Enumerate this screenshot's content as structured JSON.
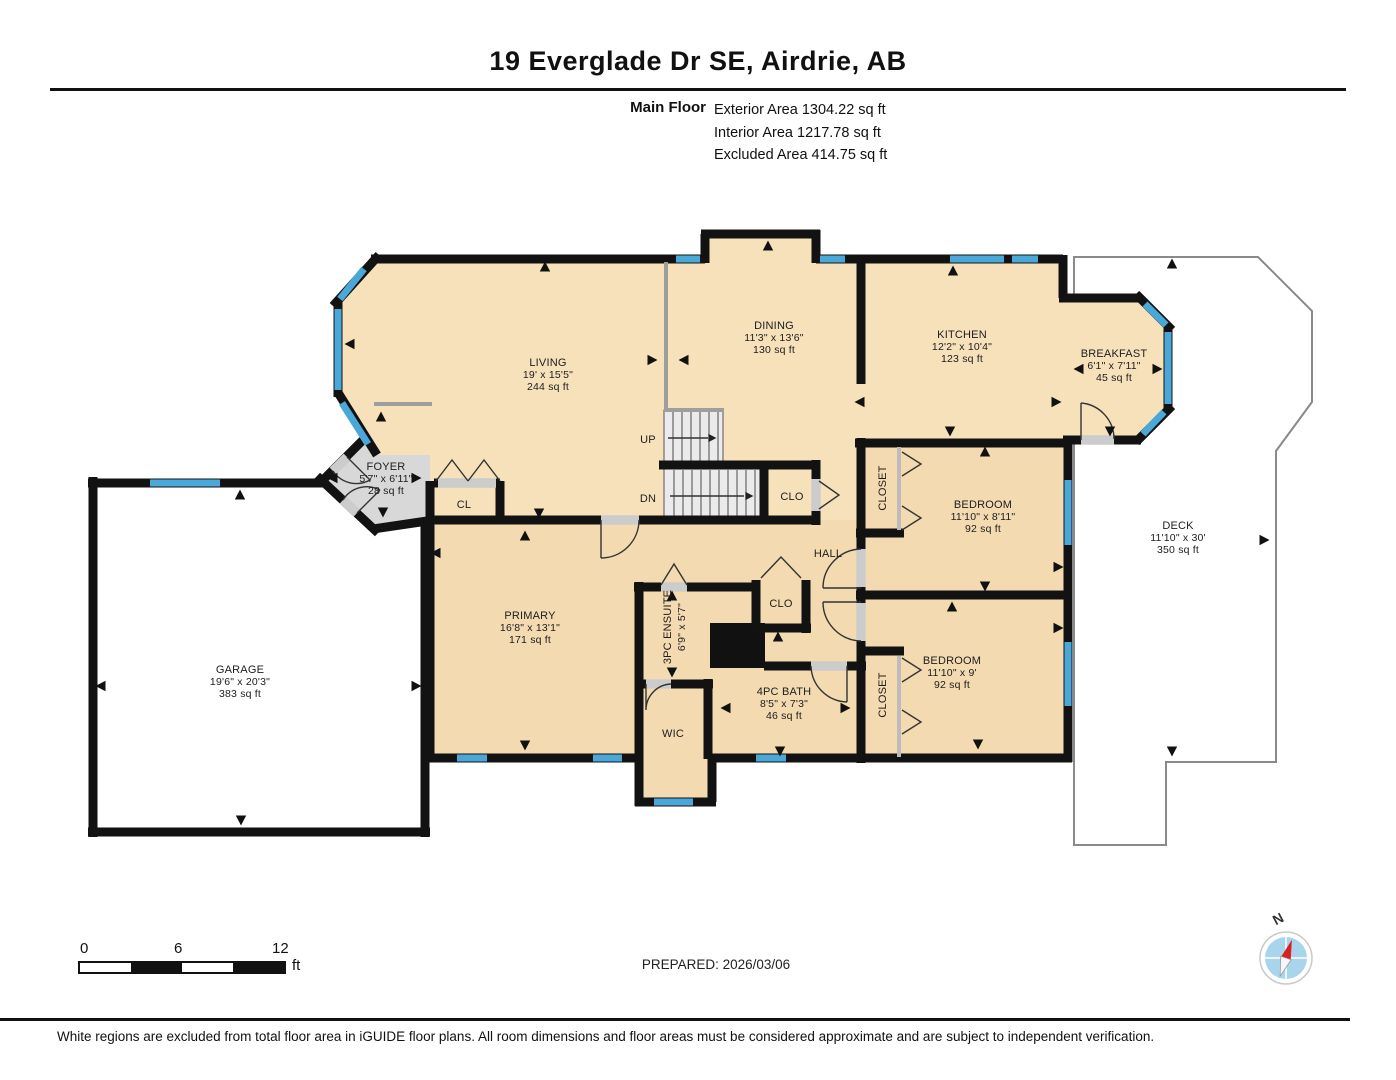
{
  "header": {
    "title": "19 Everglade Dr SE, Airdrie, AB",
    "floor_label": "Main Floor",
    "areas": [
      "Exterior Area 1304.22 sq ft",
      "Interior Area 1217.78 sq ft",
      "Excluded Area 414.75 sq ft"
    ]
  },
  "rooms": {
    "living": {
      "name": "LIVING",
      "dims": "19' x 15'5\"",
      "area": "244 sq ft"
    },
    "dining": {
      "name": "DINING",
      "dims": "11'3\" x 13'6\"",
      "area": "130 sq ft"
    },
    "kitchen": {
      "name": "KITCHEN",
      "dims": "12'2\" x 10'4\"",
      "area": "123 sq ft"
    },
    "breakfast": {
      "name": "BREAKFAST",
      "dims": "6'1\" x 7'11\"",
      "area": "45 sq ft"
    },
    "foyer": {
      "name": "FOYER",
      "dims": "5'7\" x 6'11\"",
      "area": "28 sq ft"
    },
    "garage": {
      "name": "GARAGE",
      "dims": "19'6\" x 20'3\"",
      "area": "383 sq ft"
    },
    "deck": {
      "name": "DECK",
      "dims": "11'10\" x 30'",
      "area": "350 sq ft"
    },
    "primary": {
      "name": "PRIMARY",
      "dims": "16'8\" x 13'1\"",
      "area": "171 sq ft"
    },
    "ensuite": {
      "name": "3PC ENSUITE",
      "dims": "6'9\" x 5'7\""
    },
    "bath": {
      "name": "4PC BATH",
      "dims": "8'5\" x 7'3\"",
      "area": "46 sq ft"
    },
    "bedroom1": {
      "name": "BEDROOM",
      "dims": "11'10\" x 8'11\"",
      "area": "92 sq ft"
    },
    "bedroom2": {
      "name": "BEDROOM",
      "dims": "11'10\" x 9'",
      "area": "92 sq ft"
    },
    "hall": {
      "name": "HALL"
    },
    "wic": {
      "name": "WIC"
    },
    "closet_living": {
      "name": "CL"
    },
    "closet_stair": {
      "name": "CLO"
    },
    "closet_hall": {
      "name": "CLO"
    },
    "closet_bedroom1": {
      "name": "CLOSET"
    },
    "closet_bedroom2": {
      "name": "CLOSET"
    },
    "stairs_up": {
      "name": "UP"
    },
    "stairs_dn": {
      "name": "DN"
    }
  },
  "scale": {
    "ticks": [
      "0",
      "6",
      "12"
    ],
    "unit": "ft"
  },
  "prepared": "PREPARED: 2026/03/06",
  "compass": {
    "north_label": "N"
  },
  "footer": "White regions are excluded from total floor area in iGUIDE floor plans. All room dimensions and floor areas must be considered approximate and are subject to independent verification.",
  "colors": {
    "wall": "#121212",
    "window": "#4aa8d8",
    "floor_upper": "#f7e1bb",
    "floor_lower": "#f3dab1",
    "foyer": "#d8d8d8",
    "stairs": "#ececec",
    "excluded": "#ffffff",
    "compass_needle": "#d91f1f",
    "compass_disc": "#a9d5ec"
  }
}
